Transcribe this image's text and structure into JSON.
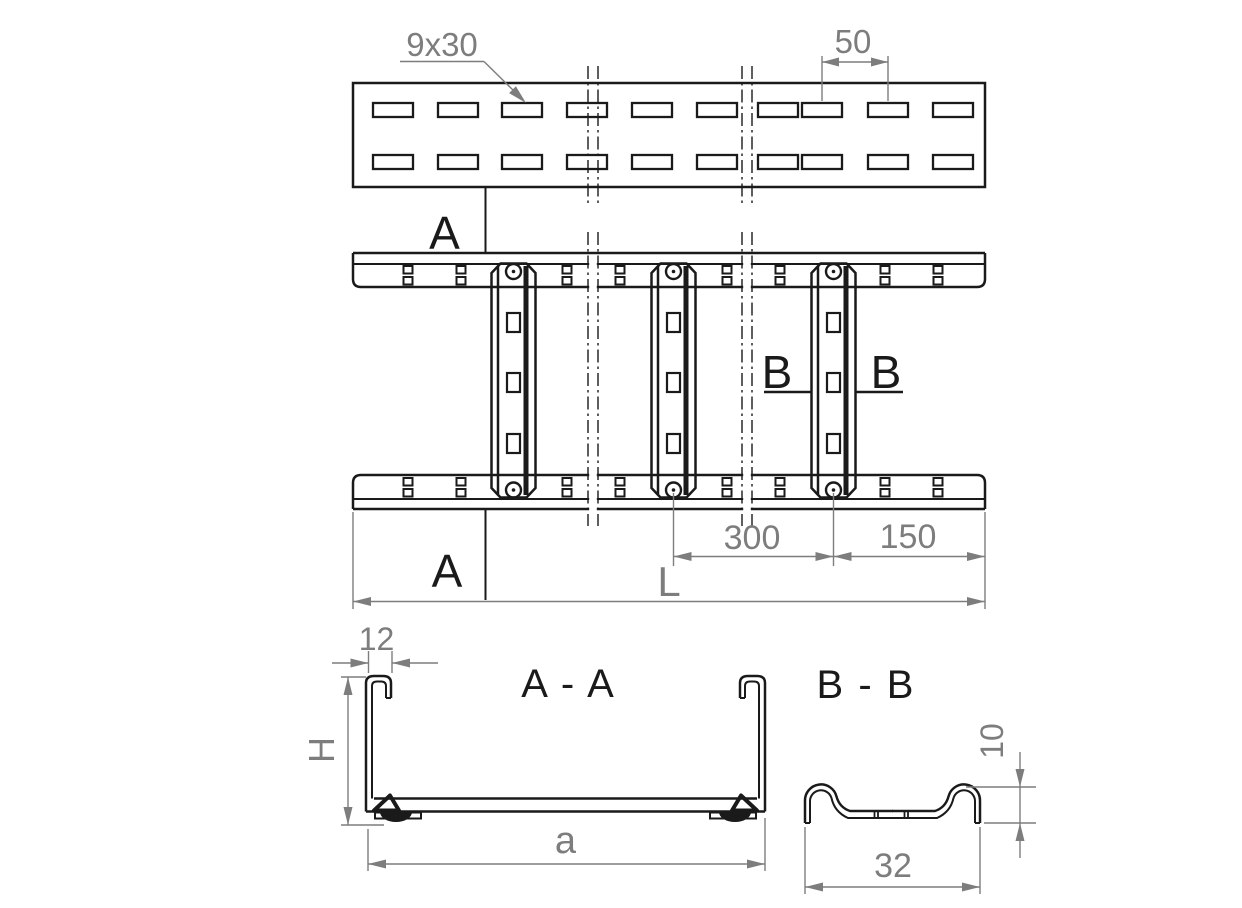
{
  "drawing": {
    "background_color": "#ffffff",
    "line_color": "#1a1a1a",
    "dimension_color": "#7d7d7d",
    "top_view": {
      "slot_size_label": "9x30",
      "slot_pitch_label": "50"
    },
    "plan_view": {
      "section_a_top_label": "A",
      "section_a_bottom_label": "A",
      "section_b_left_label": "B",
      "section_b_right_label": "B",
      "rung_spacing_label": "300",
      "end_distance_label": "150",
      "total_length_label": "L"
    },
    "section_aa": {
      "title": "A - A",
      "lip_width_label": "12",
      "height_label": "H",
      "inner_width_label": "a"
    },
    "section_bb": {
      "title": "B - B",
      "height_label": "10",
      "width_label": "32"
    }
  }
}
